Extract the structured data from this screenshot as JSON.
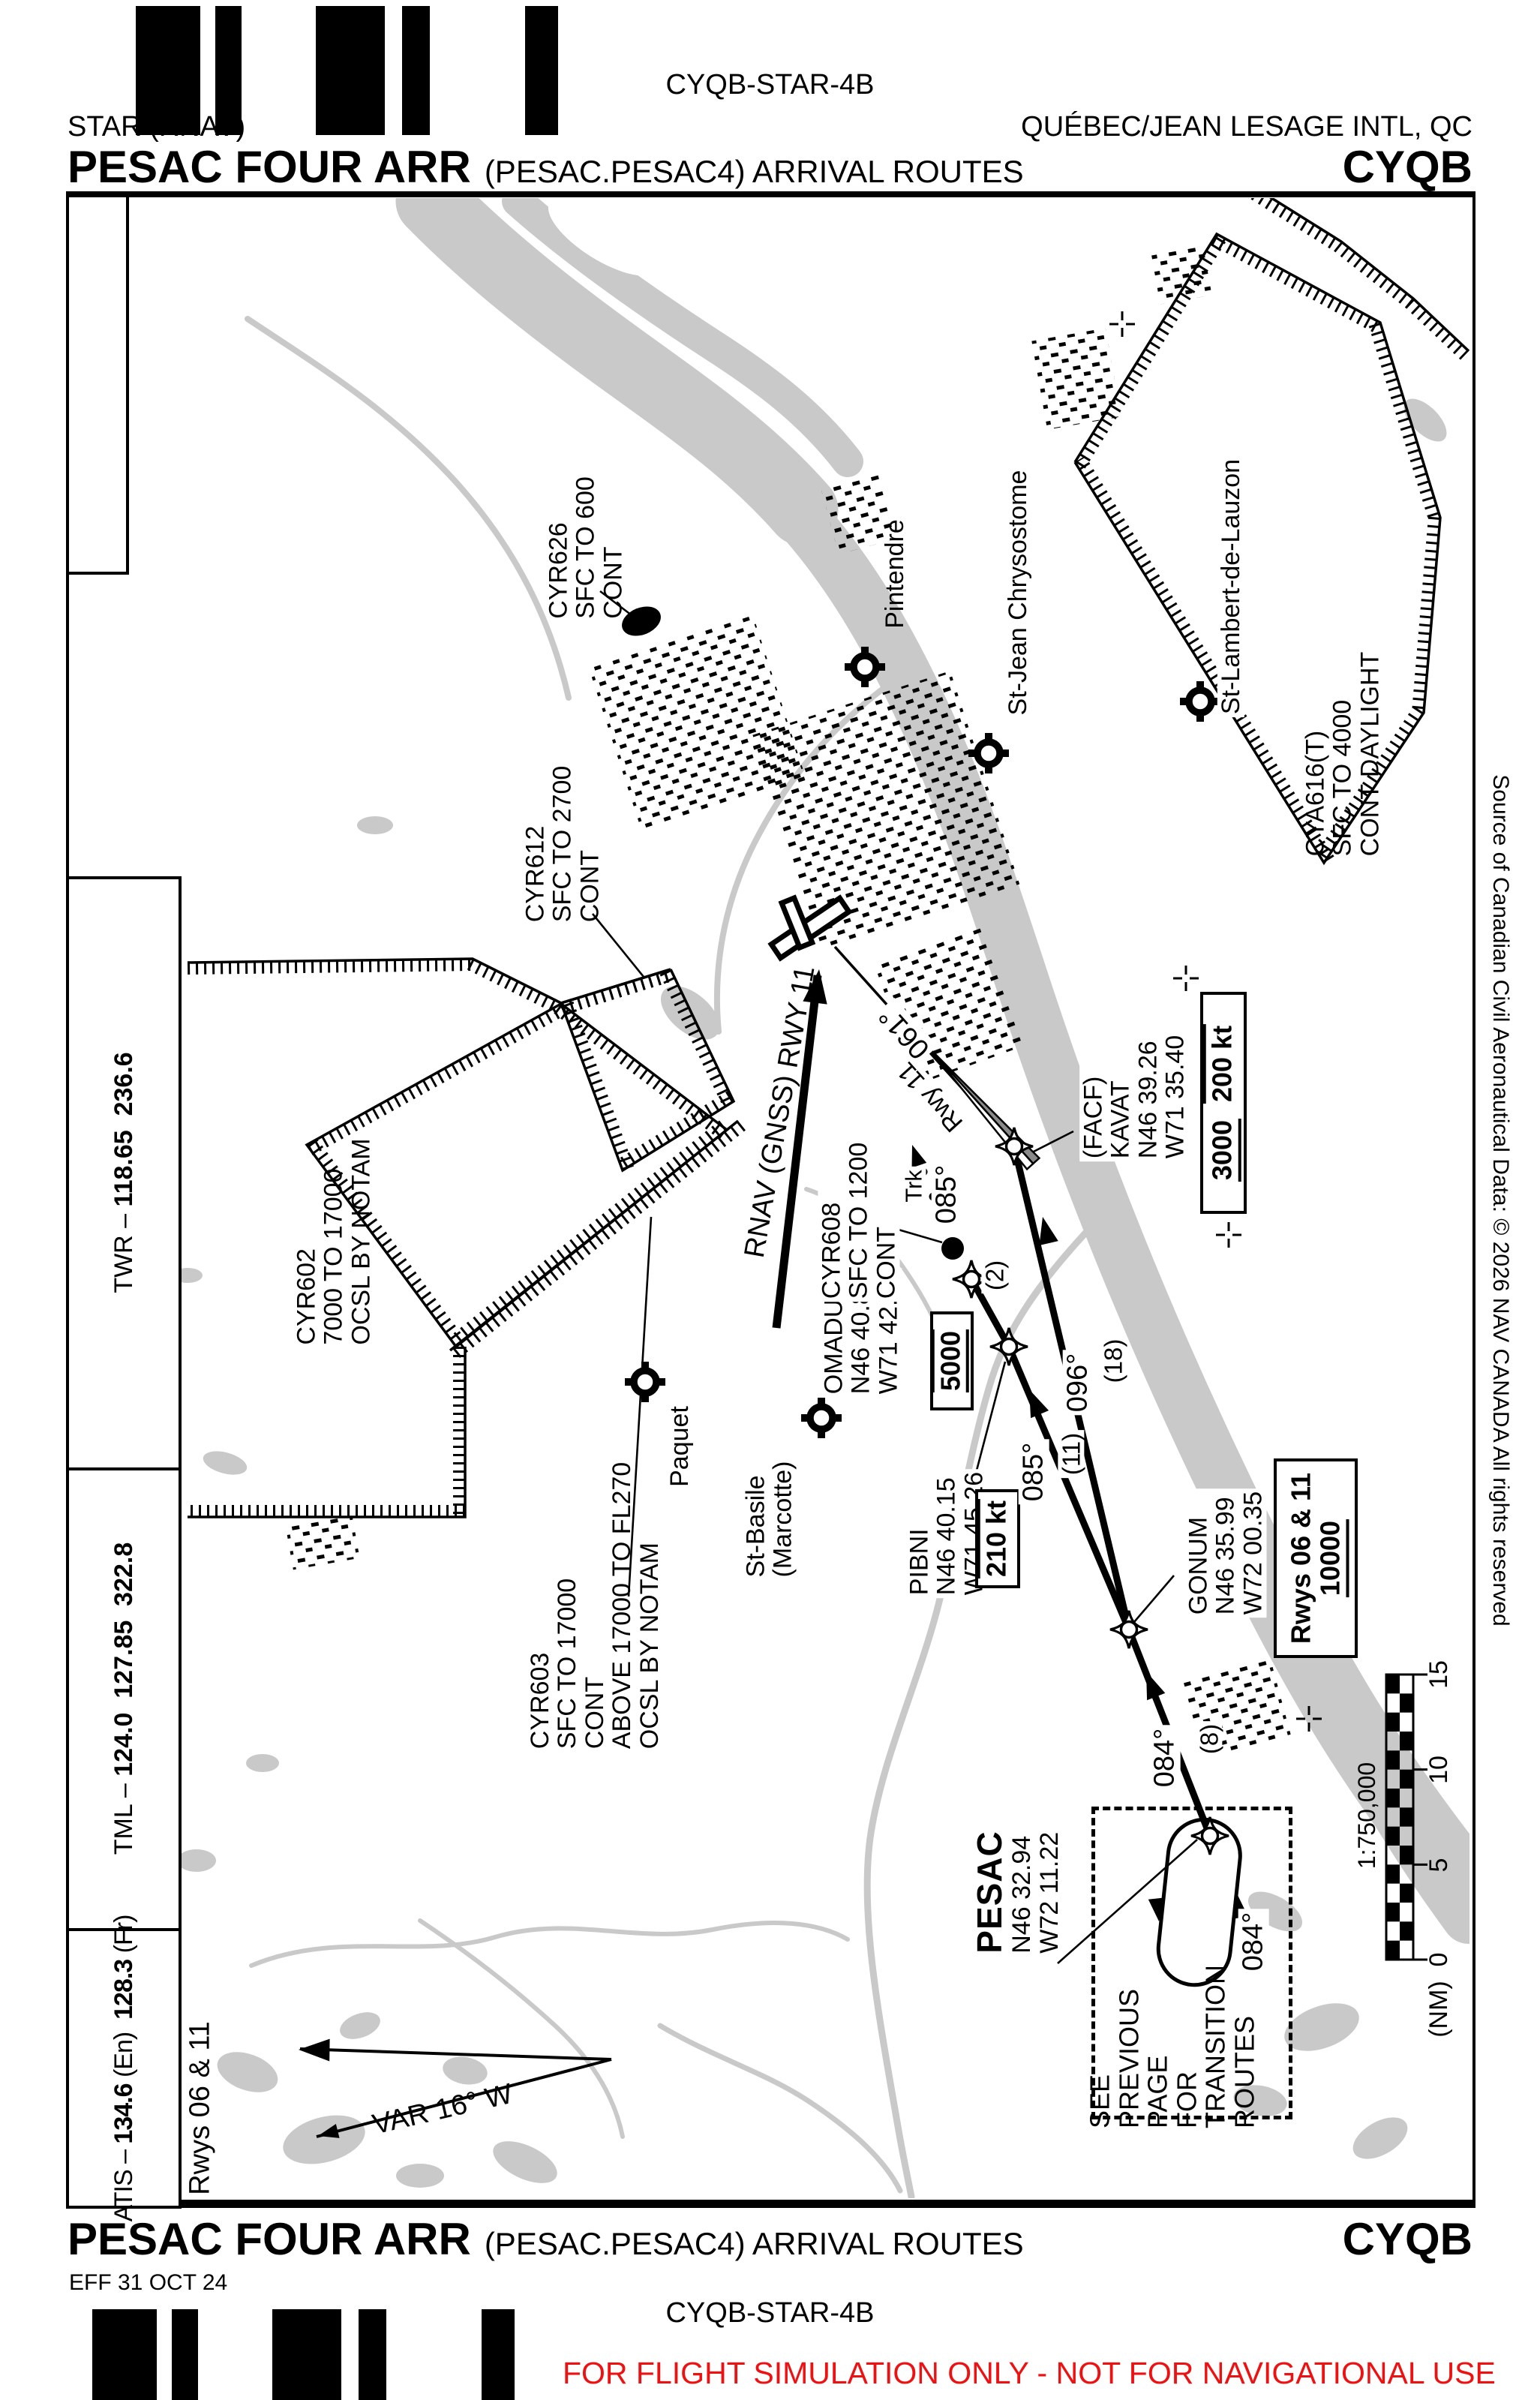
{
  "header": {
    "chart_code": "CYQB-STAR-4B",
    "chart_type": "STAR (RNAV)",
    "airport_name": "QUÉBEC/JEAN LESAGE INTL, QC",
    "procedure_title": "PESAC FOUR ARR",
    "procedure_subtitle": "(PESAC.PESAC4) ARRIVAL ROUTES",
    "airport_code": "CYQB"
  },
  "footer": {
    "procedure_title": "PESAC FOUR ARR",
    "procedure_subtitle": "(PESAC.PESAC4) ARRIVAL ROUTES",
    "airport_code": "CYQB",
    "effective_date": "EFF 31 OCT 24",
    "chart_code": "CYQB-STAR-4B",
    "disclaimer": "FOR FLIGHT SIMULATION ONLY - NOT FOR NAVIGATIONAL USE"
  },
  "frequencies": {
    "twr_label": "TWR –",
    "twr_f1": "118.65",
    "twr_f2": "236.6",
    "tml_label": "TML –",
    "tml_f1": "124.0",
    "tml_f2": "127.85",
    "tml_f3": "322.8",
    "atis_label": "ATIS –",
    "atis_f1": "134.6",
    "atis_f1_lang": "(En)",
    "atis_f2": "128.3",
    "atis_f2_lang": "(Fr)"
  },
  "map": {
    "runways_note": "Rwys 06 & 11",
    "variation": "VAR 16° W",
    "source_note": "Source of Canadian Civil Aeronautical Data: © 2026 NAV CANADA All rights reserved",
    "approach_label": "RNAV (GNSS) RWY 11",
    "scale": {
      "ratio": "1:750,000",
      "unit": "(NM)",
      "t0": "0",
      "t5": "5",
      "t10": "10",
      "t15": "15"
    },
    "transition_note": [
      "SEE",
      "PREVIOUS",
      "PAGE",
      "FOR",
      "TRANSITION",
      "ROUTES"
    ],
    "waypoints": {
      "pesac": {
        "name": "PESAC",
        "lat": "N46 32.94",
        "lon": "W72 11.22"
      },
      "gonum": {
        "name": "GONUM",
        "lat": "N46 35.99",
        "lon": "W72 00.35"
      },
      "pibni": {
        "name": "PIBNI",
        "lat": "N46 40.15",
        "lon": "W71 45.26"
      },
      "omadu": {
        "name": "OMADU",
        "lat": "N46 40.89",
        "lon": "W71 42.57"
      },
      "kavat": {
        "prefix": "(FACF)",
        "name": "KAVAT",
        "lat": "N46 39.26",
        "lon": "W71 35.40"
      }
    },
    "restriction_boxes": {
      "gonum_rwys": "Rwys 06 & 11",
      "gonum_alt": "10000",
      "kavat_alt": "3000",
      "kavat_speed": "200 kt",
      "omadu_alt": "5000",
      "pibni_speed": "210 kt"
    },
    "course_labels": {
      "pesac_gonum_crs": "084°",
      "pesac_gonum_dist": "(8)",
      "gonum_pibni_crs": "085°",
      "gonum_pibni_dist": "(11)",
      "gonum_kavat_crs": "096°",
      "gonum_kavat_dist": "(18)",
      "pibni_omadu_dist": "(2)",
      "omadu_trk_prefix": "Trk",
      "omadu_trk_crs": "085°",
      "rwy11_label": "Rwy 11",
      "rwy11_crs": "061°",
      "holding_crs": "084°"
    },
    "airspace": {
      "cyr602": [
        "CYR602",
        "7000 TO 17000",
        "OCSL BY NOTAM"
      ],
      "cyr603": [
        "CYR603",
        "SFC TO 17000",
        "CONT",
        "ABOVE 17000 TO FL270",
        "OCSL BY NOTAM"
      ],
      "cyr608": [
        "CYR608",
        "SFC TO 1200",
        "CONT"
      ],
      "cyr612": [
        "CYR612",
        "SFC TO 2700",
        "CONT"
      ],
      "cyr626": [
        "CYR626",
        "SFC TO 600",
        "CONT"
      ],
      "cya616": [
        "CYA616(T)",
        "SFC TO 4000",
        "CONT DAYLIGHT"
      ]
    },
    "places": {
      "pintendre": "Pintendre",
      "stjean": "St-Jean Chrysostome",
      "stlambert": "St-Lambert-de-Lauzon",
      "paquet": "Paquet",
      "stbasile1": "St-Basile",
      "stbasile2": "(Marcotte)"
    }
  }
}
